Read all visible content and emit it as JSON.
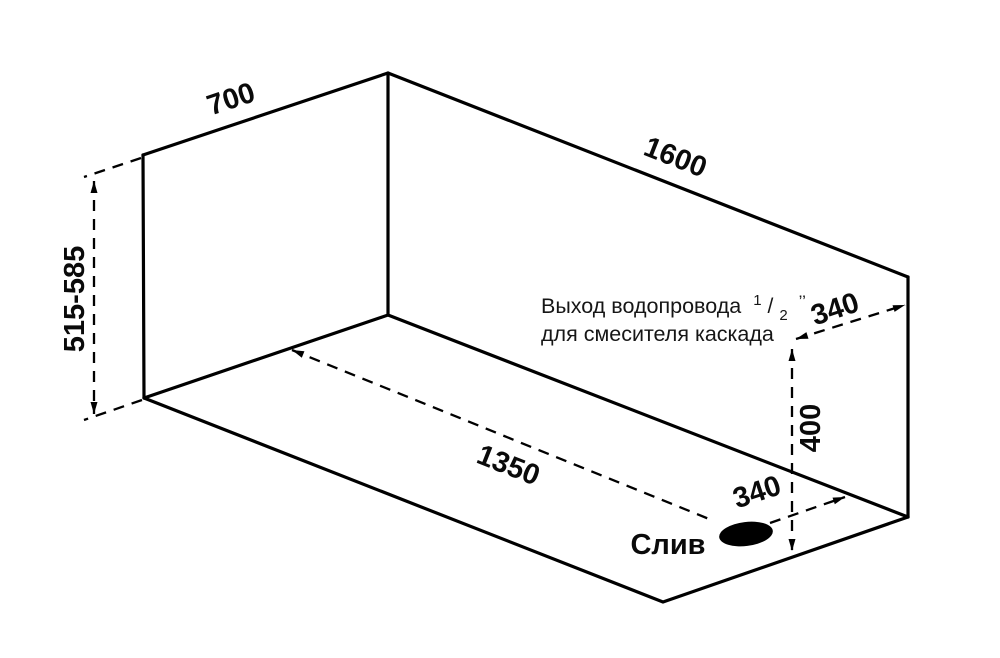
{
  "diagram": {
    "background_color": "#ffffff",
    "line_color": "#000000",
    "dimensions": {
      "width_top": "700",
      "length_top": "1600",
      "height_range": "515-585",
      "drain_diagonal": "1350",
      "outlet_from_edge": "340",
      "outlet_height": "400",
      "drain_from_wall": "340"
    },
    "labels": {
      "drain": "Слив",
      "outlet_note": {
        "prefix": "Выход водопровода",
        "sup": "1",
        "slash": "/",
        "sub": "2",
        "quote": "’’",
        "line2": "для смесителя каскада"
      }
    }
  }
}
